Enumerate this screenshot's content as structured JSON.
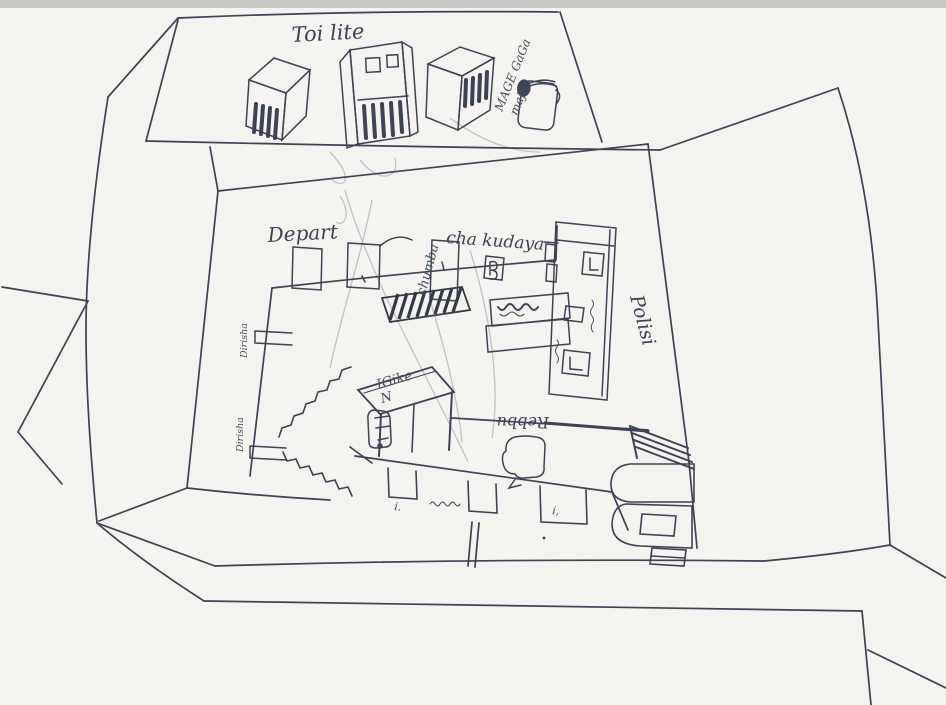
{
  "colors": {
    "paper": "#f4f3ef",
    "ink": "#3d4254",
    "ink_light": "#6a7080",
    "pencil": "#b6b9c2",
    "scan_edge": "#c7c7c4"
  },
  "labels": {
    "toilet": "Toi lite",
    "water_line1": "MAGE GaGa",
    "water_line2": "mají",
    "depart": "Depart",
    "room_vertical": "chumba",
    "room_rest": "cha kudaya",
    "police": "Polisi",
    "table_line1": "IGike",
    "table_line2": "N",
    "upside_down_wall": "Rebbu",
    "window_top": "Dirisha",
    "window_bottom": "Dirisha",
    "doorway_mark_left": "i.",
    "doorway_mark_right": "i,",
    "illegible_note": "(tiny illegible scribbles near cells, bench and middle doorway)"
  }
}
